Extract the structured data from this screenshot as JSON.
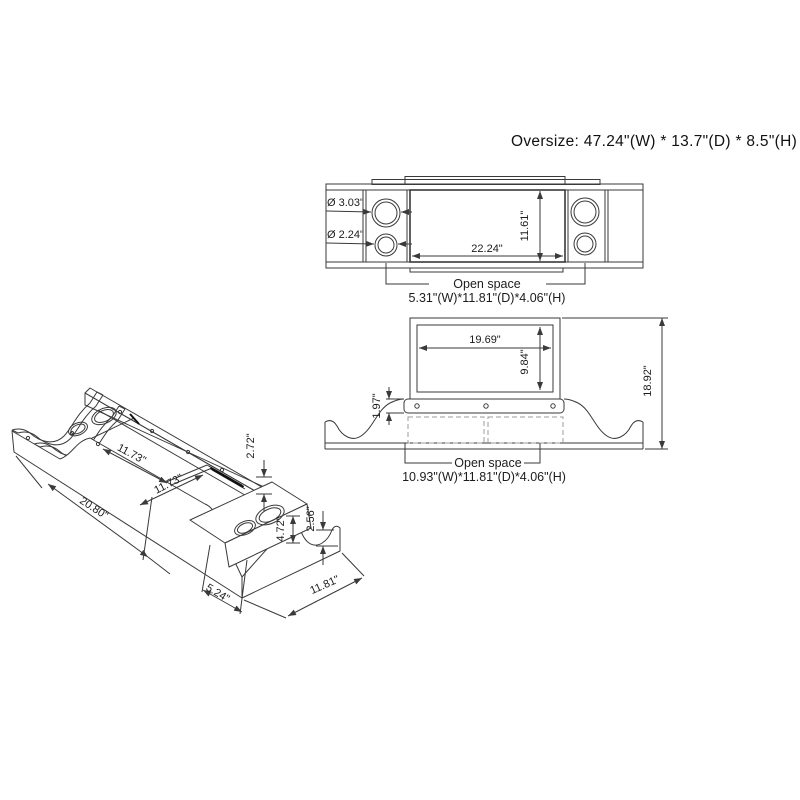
{
  "title": "Oversize: 47.24\"(W) * 13.7\"(D) * 8.5\"(H)",
  "top_view": {
    "dims": {
      "hole_large": "Ø 3.03\"",
      "hole_small": "Ø 2.24\"",
      "opening_width": "22.24\"",
      "opening_depth": "11.61\""
    },
    "open_space": {
      "line1": "Open space",
      "line2": "5.31\"(W)*11.81\"(D)*4.06\"(H)"
    }
  },
  "front_view": {
    "dims": {
      "riser_width": "19.69\"",
      "riser_height": "9.84\"",
      "ledge_height": "1.97\"",
      "total_height": "18.92\""
    },
    "open_space": {
      "line1": "Open space",
      "line2": "10.93\"(W)*11.81\"(D)*4.06\"(H)"
    }
  },
  "iso_view": {
    "dims": {
      "compartment_length": "11.73\"",
      "compartment_depth": "11.73\"",
      "overall_length": "20.80\"",
      "end_section_width": "5.24\"",
      "depth": "11.81\"",
      "platform_height": "4.72\"",
      "end_cap_height": "2.56\"",
      "wall_height": "2.72\""
    }
  },
  "colors": {
    "line": "#3a3a3a",
    "text": "#1c1c1c",
    "dashed": "#9b9b9b",
    "background": "#ffffff"
  }
}
